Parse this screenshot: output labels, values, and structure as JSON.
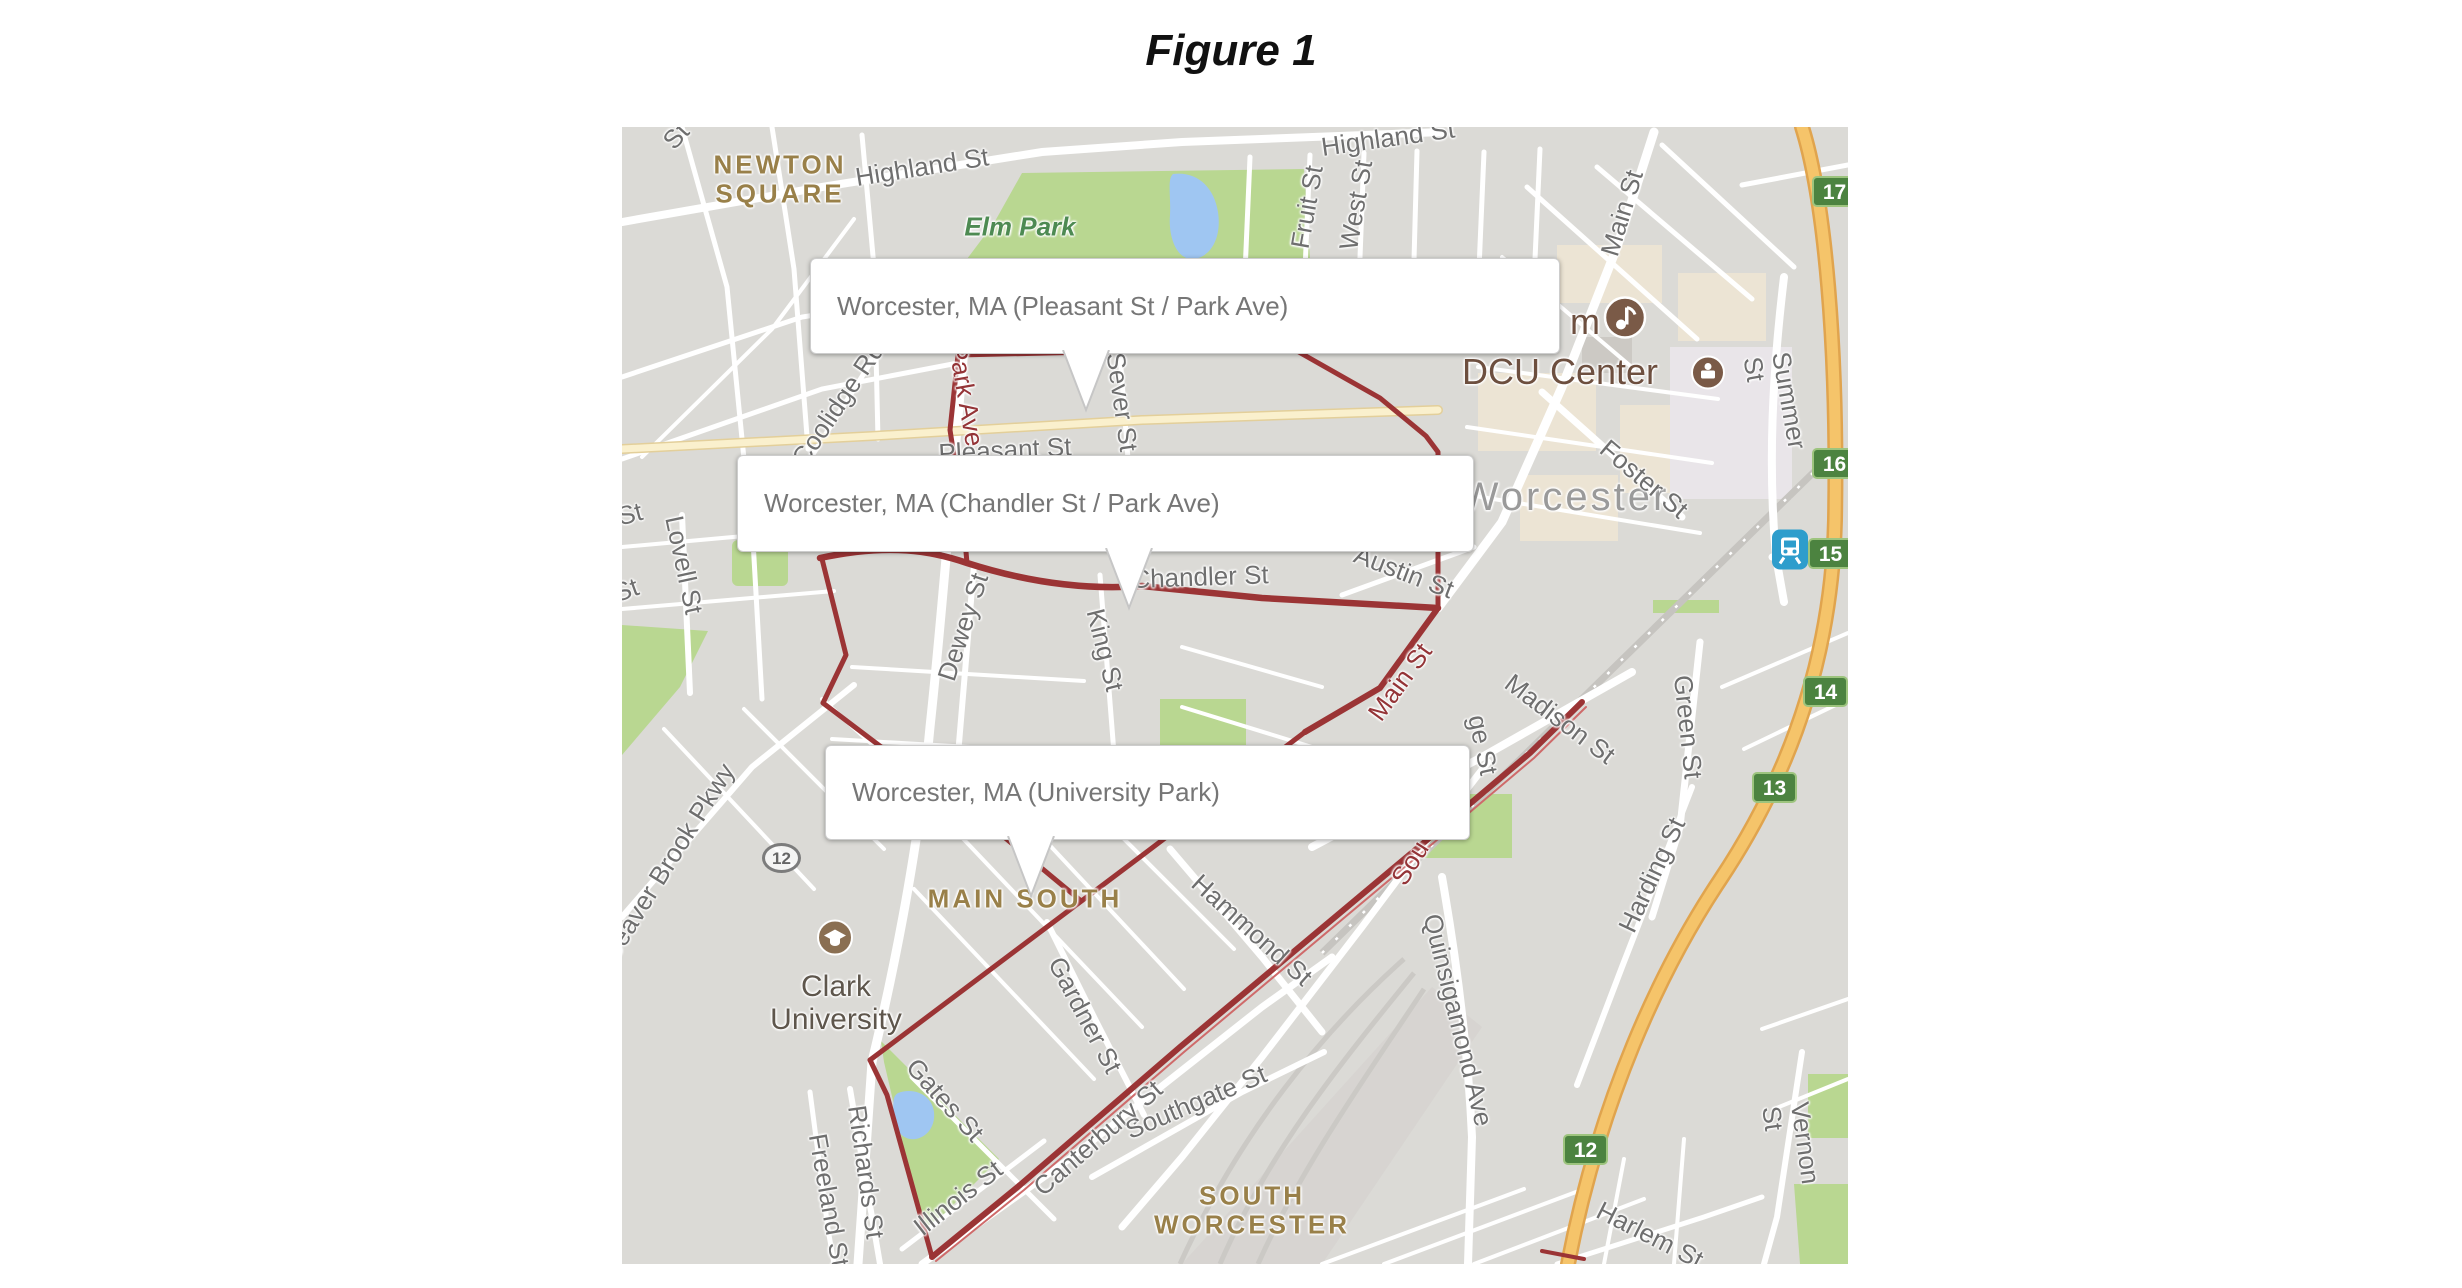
{
  "page": {
    "title": "Figure 1"
  },
  "colors": {
    "boundary_red": "#9b3435",
    "badge_green": "#4c8340",
    "highway_orange": "#f5c46a",
    "park_green": "#b9d791",
    "water_blue": "#9fc6f2",
    "poi_brown": "#7a5a47",
    "train_blue": "#2e9dcc"
  },
  "map": {
    "callouts": [
      {
        "label": "Worcester, MA (Pleasant St / Park Ave)",
        "x": 188,
        "y": 131,
        "w": 748,
        "h": 94,
        "pointer_x": 463
      },
      {
        "label": "Worcester, MA (Chandler St / Park Ave)",
        "x": 115,
        "y": 328,
        "w": 735,
        "h": 95,
        "pointer_x": 506
      },
      {
        "label": "Worcester, MA (University Park)",
        "x": 203,
        "y": 618,
        "w": 643,
        "h": 93,
        "pointer_x": 408
      }
    ],
    "route_badges": [
      {
        "n": "17",
        "x": 1190,
        "y": 49
      },
      {
        "n": "16",
        "x": 1190,
        "y": 321
      },
      {
        "n": "15",
        "x": 1186,
        "y": 411
      },
      {
        "n": "14",
        "x": 1181,
        "y": 549
      },
      {
        "n": "13",
        "x": 1130,
        "y": 645
      },
      {
        "n": "12",
        "x": 941,
        "y": 1007
      }
    ],
    "route_shield": {
      "n": "12",
      "x": 140,
      "y": 716
    },
    "icons": [
      {
        "name": "music-venue-icon",
        "type": "music",
        "x": 1003,
        "y": 193,
        "r": 21,
        "color": "#7a5a47"
      },
      {
        "name": "stadium-icon",
        "type": "stadium",
        "x": 1086,
        "y": 248,
        "r": 16,
        "color": "#7a5a47"
      },
      {
        "name": "university-icon",
        "type": "grad-cap",
        "x": 213,
        "y": 813,
        "r": 17,
        "color": "#8a6f52"
      },
      {
        "name": "train-station-icon",
        "type": "train",
        "x": 1168,
        "y": 425,
        "color": "#2e9dcc"
      }
    ],
    "labels": [
      {
        "t": "NEWTON\nSQUARE",
        "x": 158,
        "y": 52,
        "r": 0,
        "c": "nbhd"
      },
      {
        "t": "MAIN SOUTH",
        "x": 403,
        "y": 772,
        "r": 0,
        "c": "nbhd"
      },
      {
        "t": "SOUTH\nWORCESTER",
        "x": 630,
        "y": 1083,
        "r": 0,
        "c": "nbhd"
      },
      {
        "t": "Worcester",
        "x": 943,
        "y": 370,
        "r": 0,
        "c": "city"
      },
      {
        "t": "Elm Park",
        "x": 398,
        "y": 100,
        "r": 0,
        "c": "park"
      },
      {
        "t": "DCU Center",
        "x": 938,
        "y": 245,
        "r": 0,
        "c": "poilg"
      },
      {
        "t": "m",
        "x": 963,
        "y": 195,
        "r": 0,
        "c": "poilg"
      },
      {
        "t": "Clark\nUniversity",
        "x": 214,
        "y": 876,
        "r": 0,
        "c": "poi"
      },
      {
        "t": "Highland St",
        "x": 300,
        "y": 40,
        "r": -9,
        "c": "st"
      },
      {
        "t": "Highland St",
        "x": 766,
        "y": 11,
        "r": -8,
        "c": "st"
      },
      {
        "t": "Fruit St",
        "x": 685,
        "y": 80,
        "r": -80,
        "c": "st"
      },
      {
        "t": "West St",
        "x": 734,
        "y": 78,
        "r": -80,
        "c": "st"
      },
      {
        "t": "Main St",
        "x": 1000,
        "y": 86,
        "r": -73,
        "c": "st"
      },
      {
        "t": "Summer St",
        "x": 1153,
        "y": 276,
        "r": 80,
        "c": "st"
      },
      {
        "t": "Foster St",
        "x": 1022,
        "y": 352,
        "r": 40,
        "c": "st"
      },
      {
        "t": "Austin St",
        "x": 782,
        "y": 445,
        "r": 21,
        "c": "st"
      },
      {
        "t": "Pleasant St",
        "x": 383,
        "y": 323,
        "r": -3,
        "c": "st"
      },
      {
        "t": "Sever St",
        "x": 500,
        "y": 275,
        "r": 82,
        "c": "st"
      },
      {
        "t": "Chandler St",
        "x": 578,
        "y": 450,
        "r": -2,
        "c": "st"
      },
      {
        "t": "Dewey St",
        "x": 341,
        "y": 500,
        "r": -72,
        "c": "st"
      },
      {
        "t": "King St",
        "x": 483,
        "y": 523,
        "r": 76,
        "c": "st"
      },
      {
        "t": "Madison St",
        "x": 938,
        "y": 592,
        "r": 37,
        "c": "st"
      },
      {
        "t": "Green St",
        "x": 1066,
        "y": 600,
        "r": 84,
        "c": "st"
      },
      {
        "t": "Harding St",
        "x": 1030,
        "y": 748,
        "r": -65,
        "c": "st"
      },
      {
        "t": "Hammond St",
        "x": 630,
        "y": 803,
        "r": 42,
        "c": "st"
      },
      {
        "t": "Quinsigamond Ave",
        "x": 836,
        "y": 893,
        "r": 76,
        "c": "st"
      },
      {
        "t": "Gardner St",
        "x": 463,
        "y": 888,
        "r": 62,
        "c": "st"
      },
      {
        "t": "Gates St",
        "x": 323,
        "y": 973,
        "r": 48,
        "c": "st"
      },
      {
        "t": "Illinois St",
        "x": 336,
        "y": 1071,
        "r": -38,
        "c": "st"
      },
      {
        "t": "Canterbury St",
        "x": 476,
        "y": 1011,
        "r": -41,
        "c": "st"
      },
      {
        "t": "Southgate St",
        "x": 574,
        "y": 975,
        "r": -23,
        "c": "st"
      },
      {
        "t": "Richards St",
        "x": 244,
        "y": 1045,
        "r": 82,
        "c": "st"
      },
      {
        "t": "Freeland St",
        "x": 207,
        "y": 1073,
        "r": 80,
        "c": "st"
      },
      {
        "t": "Beaver Brook Pkwy",
        "x": 46,
        "y": 735,
        "r": -58,
        "c": "st"
      },
      {
        "t": "Lovell St",
        "x": 62,
        "y": 438,
        "r": 78,
        "c": "st"
      },
      {
        "t": "Coolidge Rd",
        "x": 216,
        "y": 277,
        "r": -56,
        "c": "st"
      },
      {
        "t": "Vernon St",
        "x": 1169,
        "y": 1018,
        "r": 82,
        "c": "st"
      },
      {
        "t": "Harlem St",
        "x": 1028,
        "y": 1108,
        "r": 27,
        "c": "st"
      },
      {
        "t": "Park Ave",
        "x": 344,
        "y": 268,
        "r": 80,
        "c": "red"
      },
      {
        "t": "Main St",
        "x": 778,
        "y": 555,
        "r": -54,
        "c": "red"
      },
      {
        "t": "Sou",
        "x": 788,
        "y": 736,
        "r": -58,
        "c": "red"
      },
      {
        "t": "ge St",
        "x": 861,
        "y": 618,
        "r": 78,
        "c": "frag"
      },
      {
        "t": "St",
        "x": 8,
        "y": 387,
        "r": -15,
        "c": "frag"
      },
      {
        "t": "St",
        "x": 4,
        "y": 463,
        "r": -20,
        "c": "frag"
      },
      {
        "t": "St",
        "x": 54,
        "y": 9,
        "r": -48,
        "c": "frag"
      }
    ]
  }
}
